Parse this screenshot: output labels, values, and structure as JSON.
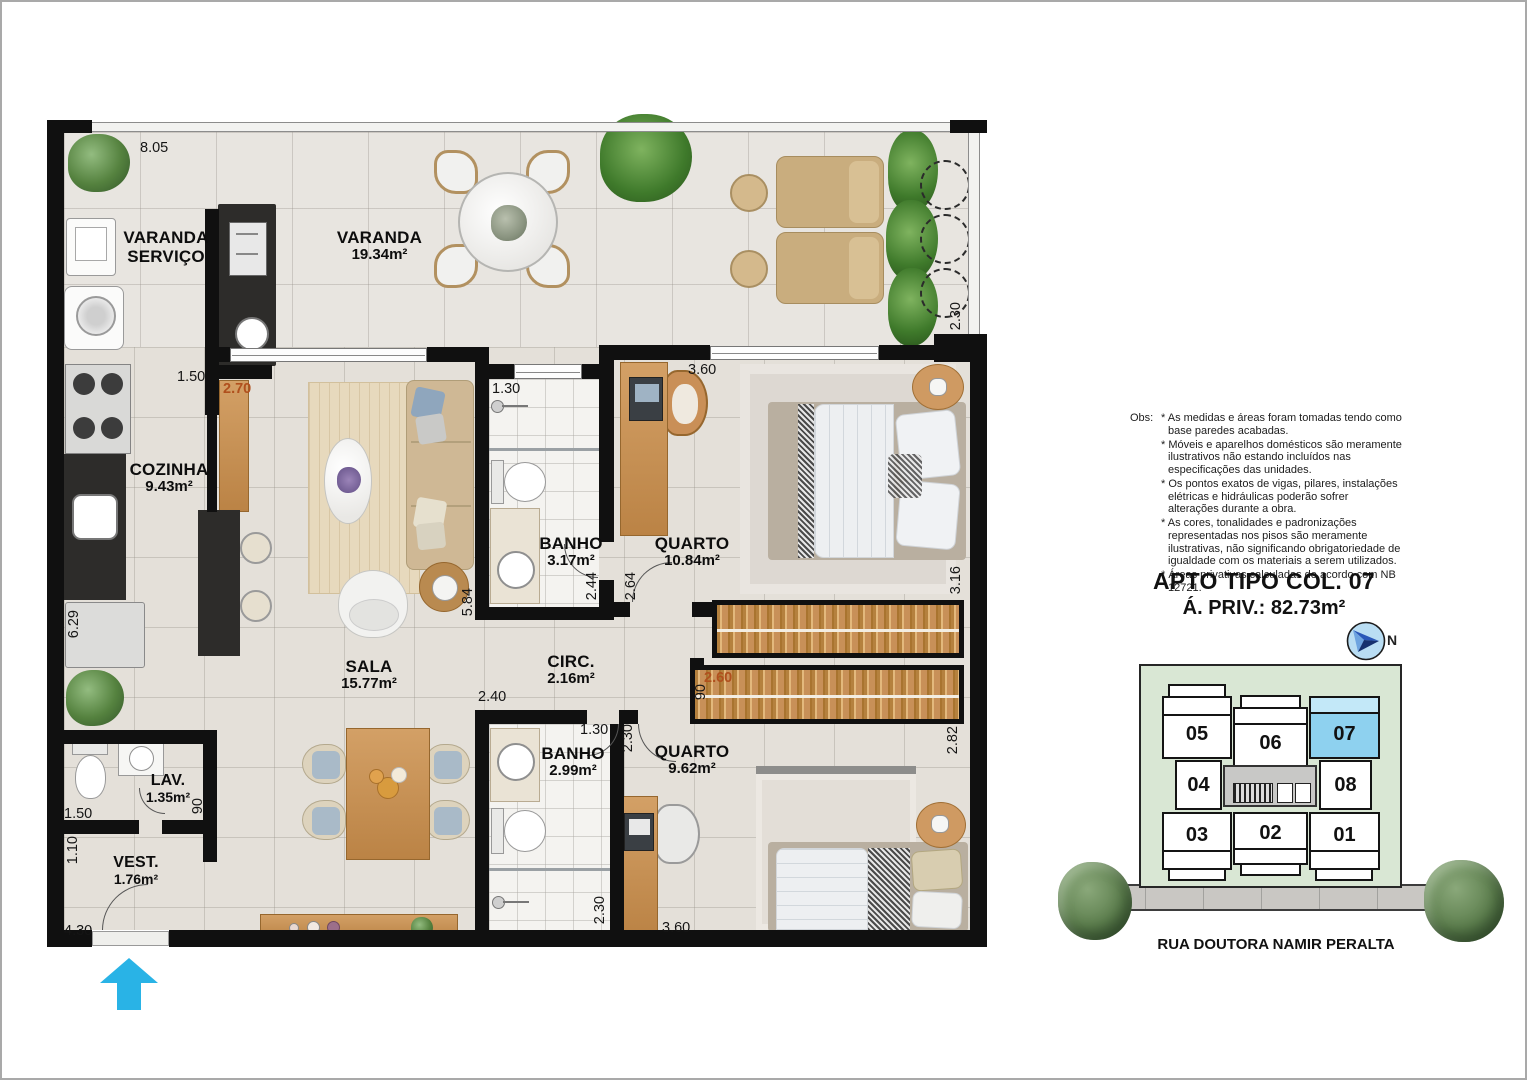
{
  "colors": {
    "dim_accent": "#b0501d",
    "unit_highlight": "#8ed1ef",
    "unit_highlight_light": "#c3e8f8",
    "entrance_arrow": "#29b3e6",
    "keyplan_bg": "#d9e7d4"
  },
  "plan": {
    "rooms": {
      "varanda_servico": {
        "line1": "VARANDA",
        "line2": "SERVIÇO"
      },
      "varanda": {
        "name": "VARANDA",
        "area": "19.34m²"
      },
      "cozinha": {
        "name": "COZINHA",
        "area": "9.43m²"
      },
      "sala": {
        "name": "SALA",
        "area": "15.77m²"
      },
      "banho1": {
        "name": "BANHO",
        "area": "3.17m²"
      },
      "quarto1": {
        "name": "QUARTO",
        "area": "10.84m²"
      },
      "circ": {
        "name": "CIRC.",
        "area": "2.16m²"
      },
      "banho2": {
        "name": "BANHO",
        "area": "2.99m²"
      },
      "quarto2": {
        "name": "QUARTO",
        "area": "9.62m²"
      },
      "lav": {
        "name": "LAV.",
        "area": "1.35m²"
      },
      "vest": {
        "name": "VEST.",
        "area": "1.76m²"
      }
    },
    "dims": {
      "top_width": "8.05",
      "kitchen_opening": "1.50",
      "cabinet": "2.70",
      "banho1_width": "1.30",
      "quarto1_width": "3.60",
      "balcony_depth": "2.30",
      "kitchen_height": "6.29",
      "sala_height": "5.84",
      "banho1_height": "2.44",
      "quarto1_door": "2.64",
      "quarto1_height": "3.16",
      "sala_width": "2.40",
      "circ_door": "90",
      "wardrobe": "2.60",
      "quarto2_height": "2.82",
      "banho2_width": "1.30",
      "banho2_door": "2.30",
      "banho2_height": "2.30",
      "quarto2_width": "3.60",
      "lav_width": "1.50",
      "lav_door": "90",
      "vest_height": "1.10",
      "vest_width": "4.30"
    }
  },
  "notes": {
    "label": "Obs:",
    "items": [
      "* As medidas e áreas foram tomadas tendo como base paredes acabadas.",
      "* Móveis e aparelhos domésticos são meramente ilustrativos não estando incluídos nas especificações das unidades.",
      "* Os pontos exatos de vigas, pilares, instalações elétricas e hidráulicas poderão sofrer alterações durante a obra.",
      "* As cores, tonalidades e padronizações representadas nos pisos são meramente ilustrativas, não significando obrigatoriedade de igualdade com os materiais a serem utilizados.",
      "* Áreas privativas calculadas de acordo com NB 12721."
    ]
  },
  "title": {
    "line1": "APTO TIPO COL. 07",
    "line2": "Á. PRIV.: 82.73m²"
  },
  "compass": {
    "label": "N"
  },
  "keyplan": {
    "units": [
      {
        "num": "05"
      },
      {
        "num": "06"
      },
      {
        "num": "07"
      },
      {
        "num": "04"
      },
      {
        "num": "08"
      },
      {
        "num": "03"
      },
      {
        "num": "02"
      },
      {
        "num": "01"
      }
    ],
    "highlight_unit": "07",
    "street": "RUA DOUTORA NAMIR PERALTA"
  }
}
